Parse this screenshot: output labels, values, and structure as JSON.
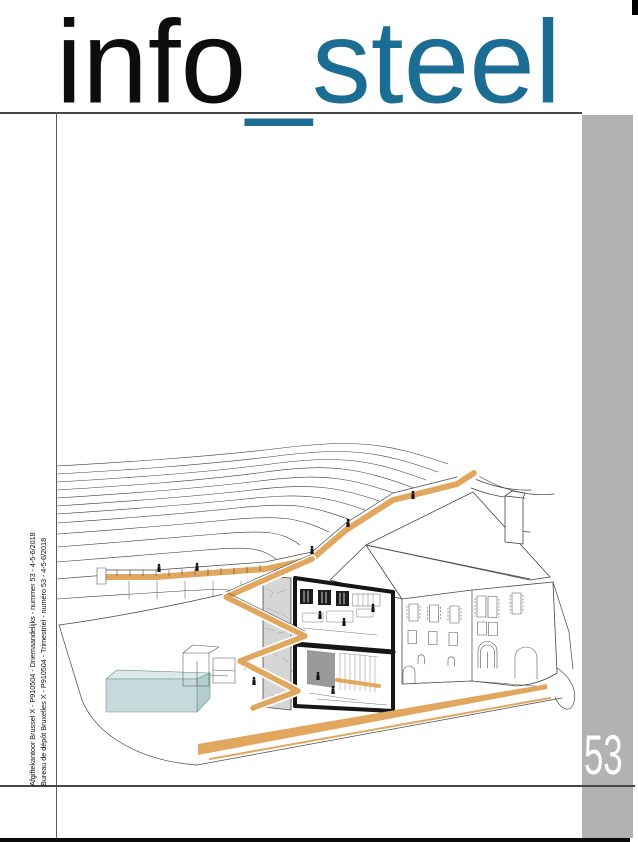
{
  "masthead": {
    "title_black": "info",
    "title_teal": "_steel"
  },
  "issue": {
    "number": "53"
  },
  "spine": {
    "line1": "Afgiftekantoor Brussel X - P910504 - Driemaandelijks - nummer 53 - 4-5-6/2018",
    "line2": "Bureau de dépôt Bruxelles X - P910504 - Trimestriel - numéro 53 - 4-5-6/2018"
  },
  "colors": {
    "brand_teal": "#1b6d94",
    "accent_orange": "#e1a75f",
    "gray_band": "#b2b2b2",
    "pool_teal": "#c2d7d9"
  }
}
